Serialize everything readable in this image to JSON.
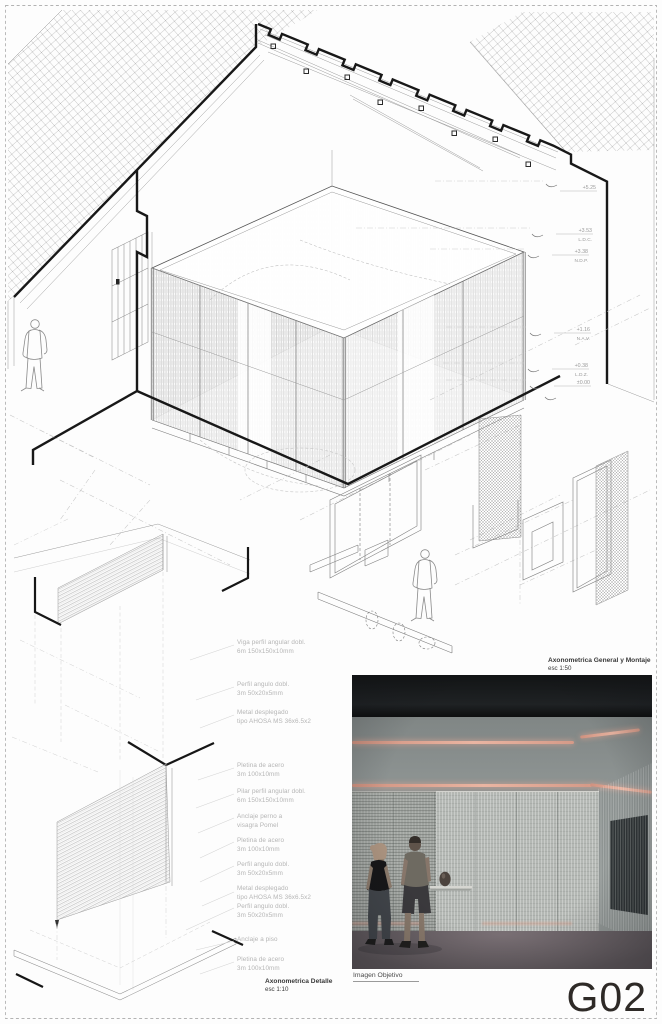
{
  "sheet": {
    "number": "G02"
  },
  "titles": {
    "general_title": "Axonometrica General y Montaje",
    "general_scale": "esc 1:50",
    "detail_title": "Axonometrica Detalle",
    "detail_scale": "esc 1:10",
    "photo_caption": "Imagen Objetivo"
  },
  "elevations": [
    {
      "value": "+5.25",
      "ref": ""
    },
    {
      "value": "+3.53",
      "ref": "L.D.C."
    },
    {
      "value": "+3.38",
      "ref": "N.D.P."
    },
    {
      "value": "+1.16",
      "ref": "N.A.V."
    },
    {
      "value": "+0.38",
      "ref": "L.D.Z."
    },
    {
      "value": "±0.00",
      "ref": ""
    }
  ],
  "annotations": {
    "upper": [
      "Viga perfil angular dobl.\n6m 150x150x10mm",
      "Perfil angulo dobl.\n3m 50x20x5mm",
      "Metal desplegado\ntipo AHOSA MS 36x6.5x2"
    ],
    "lower": [
      "Pletina de acero\n3m 100x10mm",
      "Pilar perfil angular dobl.\n6m 150x150x10mm",
      "Anclaje perno a\nvisagra Pomel",
      "Pletina de acero\n3m 100x10mm",
      "Perfil angulo dobl.\n3m 50x20x5mm",
      "Metal desplegado\ntipo AHOSA MS 36x6.5x2",
      "Perfil angulo dobl.\n3m 50x20x5mm",
      "Anclaje a piso",
      "Pletina de acero\n3m 100x10mm"
    ]
  },
  "photo": {
    "colors": {
      "ceiling": "#17191b",
      "wall": "#8d9392",
      "mesh": "#b4b8b4",
      "floor": "#6b6267",
      "light_strip": "#e2a28e"
    }
  }
}
